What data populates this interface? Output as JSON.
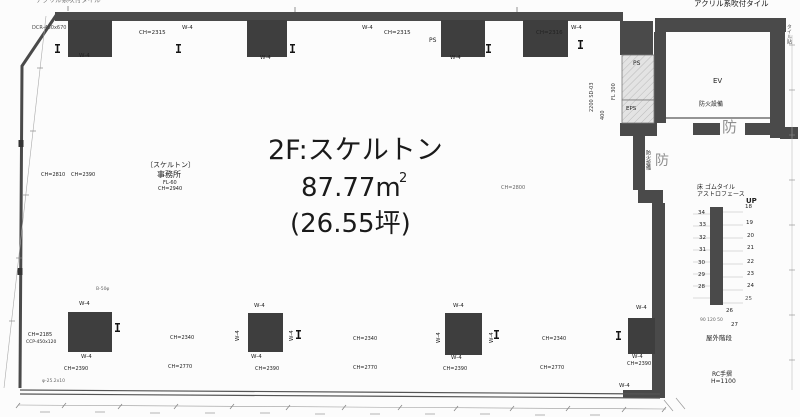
{
  "colors": {
    "wall": "#4a4a4a",
    "column": "#3e3e3e",
    "shaft_hatch": "#e3e3e3",
    "stamp_gray": "#8f8f8f"
  },
  "room": {
    "title": "2F:スケルトン",
    "area_m2": "87.77m",
    "area_m2_sup": "2",
    "area_tsubo": "(26.55坪)"
  },
  "annotations": [
    {
      "name": "note-top-left",
      "text": "アクリル系吹付タイル",
      "x": 36,
      "y": -3,
      "fs": 6.5,
      "color": "#777"
    },
    {
      "name": "note-top-right",
      "text": "アクリル系吹付タイル",
      "x": 694,
      "y": 0,
      "fs": 7.5,
      "color": "#111"
    },
    {
      "name": "label-dcr-450x670",
      "text": "DCR-450x670",
      "x": 32,
      "y": 26,
      "fs": 5,
      "color": "#444"
    },
    {
      "name": "label-ch2315-left",
      "text": "CH=2315",
      "x": 139,
      "y": 31,
      "fs": 5.5
    },
    {
      "name": "label-w4-top-1",
      "text": "W-4",
      "x": 182,
      "y": 26,
      "fs": 5.5
    },
    {
      "name": "label-w4-sill-1",
      "text": "W-4",
      "x": 79,
      "y": 54,
      "fs": 5.5
    },
    {
      "name": "label-w4-sill-2",
      "text": "W-4",
      "x": 260,
      "y": 56,
      "fs": 5.5
    },
    {
      "name": "label-w4-top-2",
      "text": "W-4",
      "x": 362,
      "y": 26,
      "fs": 5.5
    },
    {
      "name": "label-ch2315-mid",
      "text": "CH=2315",
      "x": 384,
      "y": 31,
      "fs": 5.5
    },
    {
      "name": "label-ps-top",
      "text": "PS",
      "x": 429,
      "y": 38,
      "fs": 6
    },
    {
      "name": "label-w4-sill-3",
      "text": "W-4",
      "x": 450,
      "y": 56,
      "fs": 5.5
    },
    {
      "name": "label-ch2316",
      "text": "CH=2316",
      "x": 536,
      "y": 31,
      "fs": 5.5
    },
    {
      "name": "label-w4-top-3",
      "text": "W-4",
      "x": 571,
      "y": 26,
      "fs": 5.5
    },
    {
      "name": "label-door-2200-sd03",
      "text": "2200 SD-03",
      "x": 590,
      "y": 112,
      "fs": 5,
      "rot": -90,
      "color": "#333"
    },
    {
      "name": "label-door-fl300",
      "text": "FL 300",
      "x": 612,
      "y": 100,
      "fs": 5,
      "rot": -90,
      "color": "#333"
    },
    {
      "name": "label-door-400",
      "text": "400",
      "x": 601,
      "y": 120,
      "fs": 5,
      "rot": -90,
      "color": "#333"
    },
    {
      "name": "room-title",
      "text": "2F:スケルトン",
      "x": 268,
      "y": 137,
      "fs": 27,
      "color": "#1a1a1a"
    },
    {
      "name": "room-area-m2",
      "text": "87.77m",
      "x": 301,
      "y": 175,
      "fs": 26,
      "color": "#1a1a1a"
    },
    {
      "name": "room-area-m2-sup",
      "text": "2",
      "x": 399,
      "y": 172,
      "fs": 13,
      "color": "#1a1a1a"
    },
    {
      "name": "room-area-tsubo",
      "text": "(26.55坪)",
      "x": 290,
      "y": 211,
      "fs": 26,
      "color": "#1a1a1a"
    },
    {
      "name": "label-skeleton-note",
      "text": "〔スケルトン〕",
      "x": 146,
      "y": 162,
      "fs": 7
    },
    {
      "name": "label-jimusho",
      "text": "事務所",
      "x": 157,
      "y": 171,
      "fs": 8
    },
    {
      "name": "label-fl-60",
      "text": "FL-60",
      "x": 163,
      "y": 181,
      "fs": 5
    },
    {
      "name": "label-ch2940",
      "text": "CH=2940",
      "x": 158,
      "y": 187,
      "fs": 5
    },
    {
      "name": "label-ch2800",
      "text": "CH=2800",
      "x": 501,
      "y": 186,
      "fs": 5,
      "color": "#666"
    },
    {
      "name": "label-ch2810",
      "text": "CH=2810",
      "x": 41,
      "y": 173,
      "fs": 5
    },
    {
      "name": "label-ch2390-left-wall",
      "text": "CH=2390",
      "x": 71,
      "y": 173,
      "fs": 5
    },
    {
      "name": "label-ps-shaft",
      "text": "PS",
      "x": 633,
      "y": 61,
      "fs": 6
    },
    {
      "name": "label-eps-shaft",
      "text": "EPS",
      "x": 626,
      "y": 107,
      "fs": 5.5
    },
    {
      "name": "label-ev",
      "text": "EV",
      "x": 713,
      "y": 78,
      "fs": 7
    },
    {
      "name": "label-bouka-setsubi-ev",
      "text": "防火設備",
      "x": 699,
      "y": 102,
      "fs": 6
    },
    {
      "name": "stamp-bou-1",
      "text": "防",
      "x": 722,
      "y": 120,
      "fs": 15,
      "color": "#8f8f8f"
    },
    {
      "name": "label-bouka-setsubi-vert",
      "text": "防火設備",
      "x": 645,
      "y": 150,
      "fs": 5,
      "vert": true
    },
    {
      "name": "stamp-bou-2",
      "text": "防",
      "x": 655,
      "y": 154,
      "fs": 14,
      "color": "#8f8f8f"
    },
    {
      "name": "label-floor-rubber-tile",
      "text": "床 ゴムタイル",
      "x": 697,
      "y": 185,
      "fs": 6
    },
    {
      "name": "label-astroface",
      "text": "アストロフェース",
      "x": 697,
      "y": 192,
      "fs": 6
    },
    {
      "name": "label-up",
      "text": "UP",
      "x": 746,
      "y": 198,
      "fs": 7,
      "bold": true
    },
    {
      "name": "label-tile-vert",
      "text": "タイル貼",
      "x": 786,
      "y": 24,
      "fs": 5,
      "vert": true,
      "color": "#555"
    },
    {
      "name": "stair-step-34",
      "text": "34",
      "x": 698,
      "y": 211,
      "fs": 5.5
    },
    {
      "name": "stair-step-33",
      "text": "33",
      "x": 699,
      "y": 223,
      "fs": 5.5
    },
    {
      "name": "stair-step-32",
      "text": "32",
      "x": 699,
      "y": 236,
      "fs": 5.5
    },
    {
      "name": "stair-step-31",
      "text": "31",
      "x": 699,
      "y": 248,
      "fs": 5.5
    },
    {
      "name": "stair-step-30",
      "text": "30",
      "x": 698,
      "y": 261,
      "fs": 5.5
    },
    {
      "name": "stair-step-29",
      "text": "29",
      "x": 698,
      "y": 273,
      "fs": 5.5
    },
    {
      "name": "stair-step-28",
      "text": "28",
      "x": 698,
      "y": 285,
      "fs": 5.5
    },
    {
      "name": "stair-step-18",
      "text": "18",
      "x": 745,
      "y": 205,
      "fs": 5.5
    },
    {
      "name": "stair-step-19",
      "text": "19",
      "x": 746,
      "y": 221,
      "fs": 5.5
    },
    {
      "name": "stair-step-20",
      "text": "20",
      "x": 747,
      "y": 234,
      "fs": 5.5
    },
    {
      "name": "stair-step-21",
      "text": "21",
      "x": 747,
      "y": 246,
      "fs": 5.5
    },
    {
      "name": "stair-step-22",
      "text": "22",
      "x": 747,
      "y": 260,
      "fs": 5.5
    },
    {
      "name": "stair-step-23",
      "text": "23",
      "x": 747,
      "y": 272,
      "fs": 5.5
    },
    {
      "name": "stair-step-24",
      "text": "24",
      "x": 747,
      "y": 284,
      "fs": 5.5
    },
    {
      "name": "stair-step-25",
      "text": "25",
      "x": 745,
      "y": 297,
      "fs": 5.5,
      "color": "#555"
    },
    {
      "name": "stair-step-26",
      "text": "26",
      "x": 726,
      "y": 309,
      "fs": 5.5
    },
    {
      "name": "stair-step-27",
      "text": "27",
      "x": 731,
      "y": 323,
      "fs": 5.5
    },
    {
      "name": "label-stair-dim",
      "text": "90 120 50",
      "x": 700,
      "y": 319,
      "fs": 4.5,
      "color": "#666"
    },
    {
      "name": "label-okugai-kaidan",
      "text": "屋外階段",
      "x": 706,
      "y": 335,
      "fs": 6.5
    },
    {
      "name": "label-rc-tesuri",
      "text": "RC手摺",
      "x": 712,
      "y": 372,
      "fs": 6
    },
    {
      "name": "label-h1100",
      "text": "H=1100",
      "x": 711,
      "y": 379,
      "fs": 6
    },
    {
      "name": "label-ch2185",
      "text": "CH=2185",
      "x": 28,
      "y": 333,
      "fs": 5
    },
    {
      "name": "label-ccp-450",
      "text": "CCP-450x120",
      "x": 26,
      "y": 341,
      "fs": 4.5
    },
    {
      "name": "label-b50",
      "text": "B-50φ",
      "x": 96,
      "y": 288,
      "fs": 4.5,
      "color": "#666"
    },
    {
      "name": "label-phi-25",
      "text": "φ-25.2x10",
      "x": 42,
      "y": 380,
      "fs": 4.5,
      "color": "#666"
    },
    {
      "name": "label-w4-c1-top",
      "text": "W-4",
      "x": 79,
      "y": 302,
      "fs": 5.5
    },
    {
      "name": "label-w4-c1-bottom",
      "text": "W-4",
      "x": 81,
      "y": 355,
      "fs": 5.5
    },
    {
      "name": "label-ch2390-c1",
      "text": "CH=2390",
      "x": 64,
      "y": 367,
      "fs": 5
    },
    {
      "name": "label-ch2340-bay1",
      "text": "CH=2340",
      "x": 170,
      "y": 336,
      "fs": 5
    },
    {
      "name": "label-ch2770-bay1",
      "text": "CH=2770",
      "x": 168,
      "y": 365,
      "fs": 5
    },
    {
      "name": "label-w4-c2-top",
      "text": "W-4",
      "x": 254,
      "y": 304,
      "fs": 5.5
    },
    {
      "name": "label-w4-c2-bottom",
      "text": "W-4",
      "x": 251,
      "y": 355,
      "fs": 5.5
    },
    {
      "name": "label-w4-c2-left",
      "text": "W-4",
      "x": 236,
      "y": 341,
      "fs": 5.5,
      "rot": -90
    },
    {
      "name": "label-w4-c2-right",
      "text": "W-4",
      "x": 290,
      "y": 341,
      "fs": 5.5,
      "rot": -90
    },
    {
      "name": "label-ch2390-c2",
      "text": "CH=2390",
      "x": 255,
      "y": 367,
      "fs": 5
    },
    {
      "name": "label-ch2340-bay2",
      "text": "CH=2340",
      "x": 353,
      "y": 337,
      "fs": 5
    },
    {
      "name": "label-ch2770-bay2",
      "text": "CH=2770",
      "x": 353,
      "y": 366,
      "fs": 5
    },
    {
      "name": "label-w4-c3-top",
      "text": "W-4",
      "x": 453,
      "y": 304,
      "fs": 5.5
    },
    {
      "name": "label-w4-c3-bottom",
      "text": "W-4",
      "x": 451,
      "y": 356,
      "fs": 5.5
    },
    {
      "name": "label-w4-c3-left",
      "text": "W-4",
      "x": 437,
      "y": 343,
      "fs": 5.5,
      "rot": -90
    },
    {
      "name": "label-w4-c3-right",
      "text": "W-4",
      "x": 490,
      "y": 343,
      "fs": 5.5,
      "rot": -90
    },
    {
      "name": "label-ch2390-c3",
      "text": "CH=2390",
      "x": 443,
      "y": 367,
      "fs": 5
    },
    {
      "name": "label-ch2340-bay3",
      "text": "CH=2340",
      "x": 542,
      "y": 337,
      "fs": 5
    },
    {
      "name": "label-ch2770-bay3",
      "text": "CH=2770",
      "x": 540,
      "y": 366,
      "fs": 5
    },
    {
      "name": "label-w4-c4-top",
      "text": "W-4",
      "x": 636,
      "y": 306,
      "fs": 5.5
    },
    {
      "name": "label-w4-c4-bottom",
      "text": "W-4",
      "x": 632,
      "y": 355,
      "fs": 5.5
    },
    {
      "name": "label-ch2390-c4",
      "text": "CH=2390",
      "x": 627,
      "y": 362,
      "fs": 5
    },
    {
      "name": "label-w4-c4-corner",
      "text": "W-4",
      "x": 619,
      "y": 384,
      "fs": 5.5
    }
  ]
}
